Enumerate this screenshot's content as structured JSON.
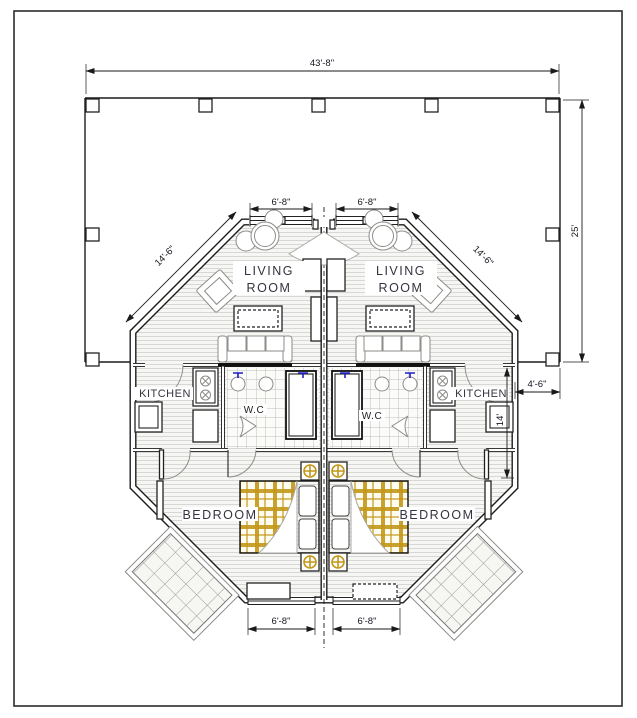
{
  "plan": {
    "rooms": {
      "living_line1": "LIVING",
      "living_line2": "ROOM",
      "kitchen": "KITCHEN",
      "wc": "W.C",
      "bedroom": "BEDROOM"
    },
    "dimensions": {
      "overall_width": "43'-8\"",
      "overall_depth": "25'",
      "window_width": "6'-8\"",
      "diagonal_wall": "14'-6\"",
      "side_offset": "4'-6\"",
      "side_depth": "14'"
    },
    "colors": {
      "wall_line": "#1c1c1c",
      "floor_hatch": "#d7d7d4",
      "tile_line": "#bfbfbc",
      "bed_plaid": "#c49718",
      "faucet_blue": "#2020c8",
      "label_text": "#33343f"
    }
  }
}
